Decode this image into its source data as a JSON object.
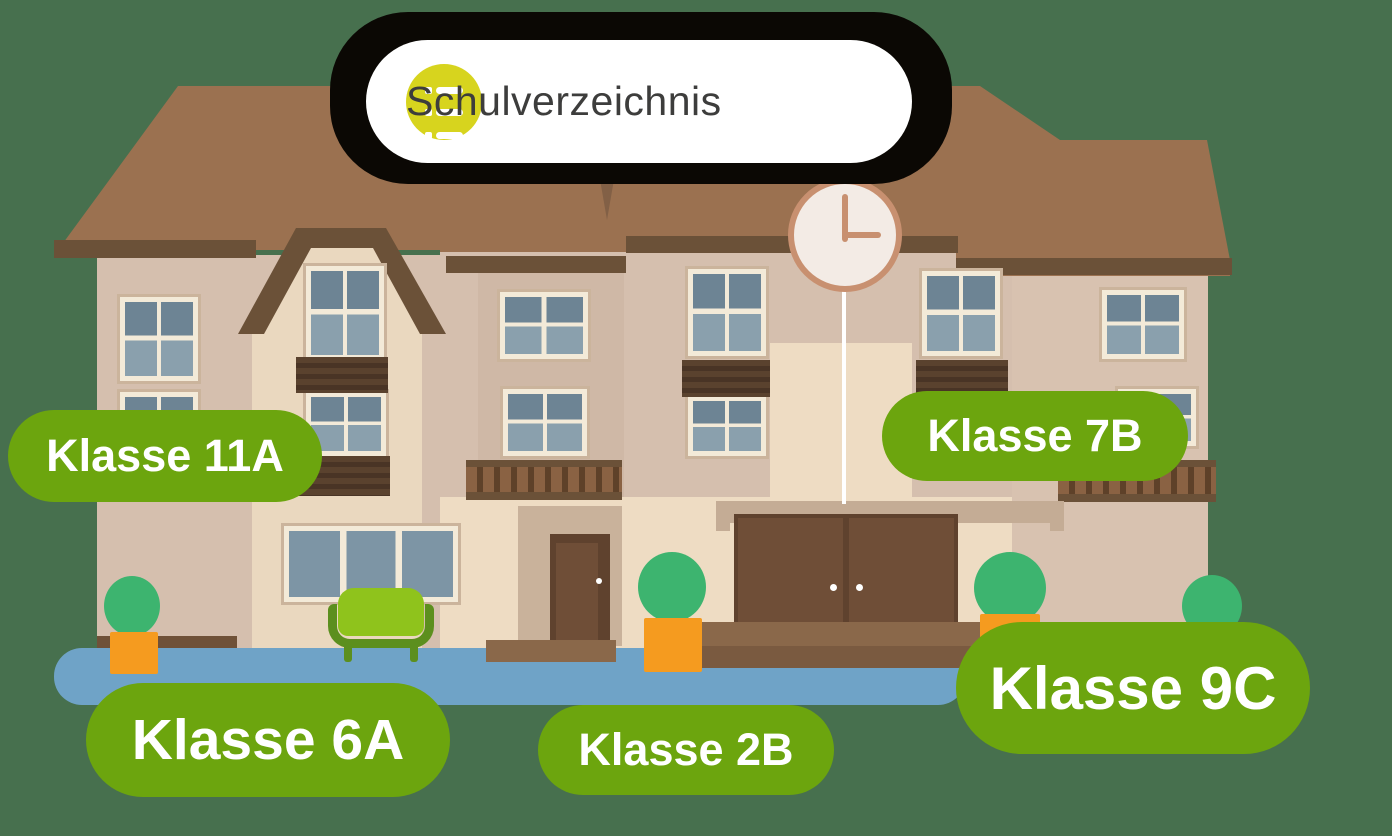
{
  "header": {
    "title": "Schulverzeichnis",
    "icon": "list-icon"
  },
  "clock": {
    "time": "3:00"
  },
  "class_labels": [
    {
      "id": "11a",
      "text": "Klasse 11A"
    },
    {
      "id": "7b",
      "text": "Klasse 7B"
    },
    {
      "id": "6a",
      "text": "Klasse 6A"
    },
    {
      "id": "2b",
      "text": "Klasse 2B"
    },
    {
      "id": "9c",
      "text": "Klasse 9C"
    }
  ],
  "colors": {
    "bg": "#47704e",
    "shadow": "#0b0804",
    "header-bg": "#ffffff",
    "header-text": "#3d3d3c",
    "icon-yellow": "#d7d41e",
    "icon-glyph": "#ffffff",
    "pill-green": "#6ca50e",
    "pill-text": "#ffffff",
    "roof": "#9b7150",
    "roof-trim": "#6b5138",
    "roof-seam": "#826046",
    "wall-tan": "#d5bfae",
    "wall-bay": "#cfb8a6",
    "wall-beige": "#ead8bf",
    "wall-light": "#eedcc3",
    "wall-right": "#d8c2b0",
    "window-frame": "#f3ead8",
    "window-outer": "#cbb49c",
    "pane-dark": "#6d8494",
    "pane-light": "#8aa0ad",
    "pane-mid": "#7d95a5",
    "louver": "#5a422e",
    "louver-stripe": "#493425",
    "door-recess": "#c9b29b",
    "door-dark": "#5f422e",
    "door-mid": "#6f4e37",
    "lintel": "#c4ac95",
    "step1": "#8a684a",
    "step2": "#7a5a40",
    "foundation": "#6f5138",
    "walkway": "#6fa3c7",
    "tree-green": "#3db46f",
    "pot-orange": "#f59b1f",
    "couch-lime": "#8fc31c",
    "couch-dark": "#5c8f1e",
    "clock-ring": "#c89070",
    "clock-face": "#f3ebe5",
    "baluster-light": "#8a6243",
    "baluster-dark": "#5e4129"
  }
}
